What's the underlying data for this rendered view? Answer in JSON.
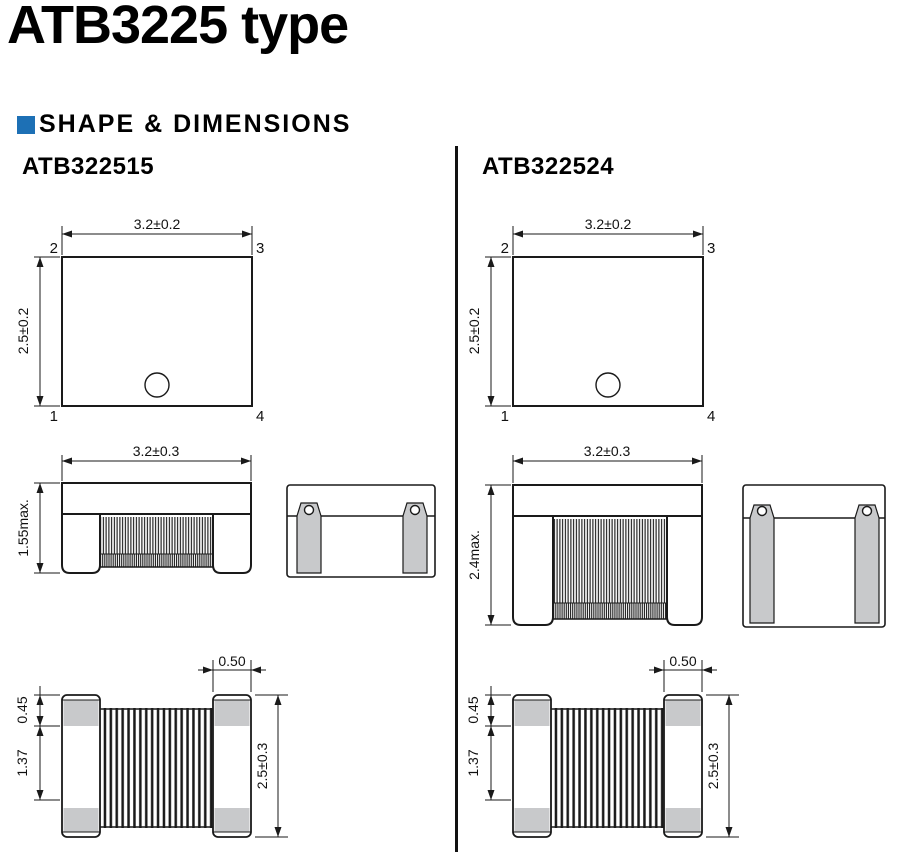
{
  "page": {
    "title": "ATB3225 type",
    "section_title": "SHAPE & DIMENSIONS"
  },
  "colors": {
    "accent_blue": "#1d70b5",
    "line": "#1a1a1a",
    "terminal_gray": "#c8c9cb"
  },
  "columns": [
    {
      "heading": "ATB322515",
      "top_view": {
        "width_dim": "3.2±0.2",
        "height_dim": "2.5±0.2",
        "pin_top_left": "2",
        "pin_top_right": "3",
        "pin_bottom_left": "1",
        "pin_bottom_right": "4"
      },
      "side_view": {
        "width_dim": "3.2±0.3",
        "height_dim": "1.55max."
      },
      "bottom_view": {
        "terminal_dim": "0.50",
        "pad_dim": "0.45",
        "gap_dim": "1.37",
        "height_dim": "2.5±0.3"
      }
    },
    {
      "heading": "ATB322524",
      "top_view": {
        "width_dim": "3.2±0.2",
        "height_dim": "2.5±0.2",
        "pin_top_left": "2",
        "pin_top_right": "3",
        "pin_bottom_left": "1",
        "pin_bottom_right": "4"
      },
      "side_view": {
        "width_dim": "3.2±0.3",
        "height_dim": "2.4max."
      },
      "bottom_view": {
        "terminal_dim": "0.50",
        "pad_dim": "0.45",
        "gap_dim": "1.37",
        "height_dim": "2.5±0.3"
      }
    }
  ]
}
